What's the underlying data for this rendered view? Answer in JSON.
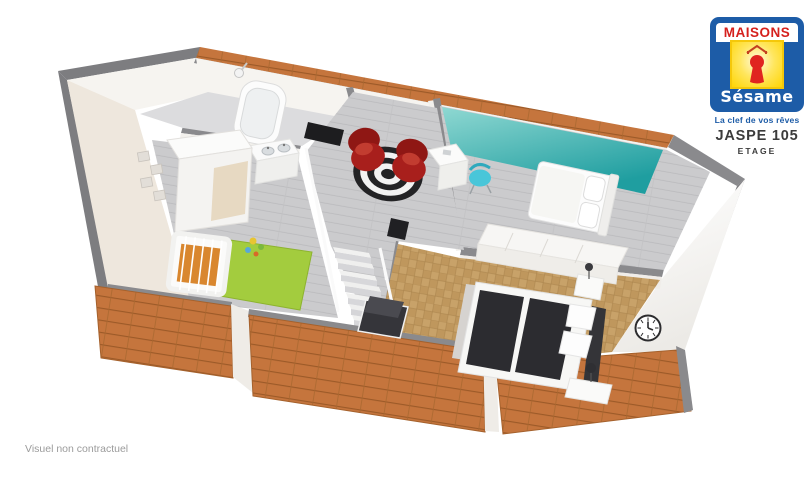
{
  "logo": {
    "brand_top": "MAISONS",
    "brand_bottom": "Sésame",
    "tagline": "La clef de vos rêves",
    "colors": {
      "blue": "#1d5ca7",
      "red": "#d5201d",
      "yellow": "#ffd504",
      "keyhole": "#e02420",
      "roof_mark": "#c3401f"
    }
  },
  "plan": {
    "model": "JASPE 105",
    "level": "ETAGE"
  },
  "footer": {
    "disclaimer": "Visuel non contractuel"
  },
  "scene": {
    "type": "3d-floorplan-cutaway",
    "level_shown": "upper floor",
    "rooms": [
      "bathroom",
      "child-bedroom",
      "landing-with-stairs",
      "bedroom-teal",
      "master-bedroom"
    ],
    "colors": {
      "roof_tile": "#c5753d",
      "roof_tile_line": "#9c5a28",
      "wall_outer": "#7d7d80",
      "wall_cap": "#8a8a8d",
      "wall_face": "#f6f4f0",
      "wall_face_shade": "#eee7dd",
      "floor_gray_wood": "#cbcbcd",
      "floor_gray_line": "#b9b9bc",
      "floor_tile_bath": "#dcdcde",
      "parquet": "#c8a269",
      "parquet_dark": "#bf975d",
      "parquet_line": "#a8824a",
      "teal_light": "#8fd8d2",
      "teal_dark": "#1f9ea0",
      "rug_green": "#a3cc3e",
      "rug_gray": "#d6d3d0",
      "chair_red": "#a81f1c",
      "chair_cyan": "#49c6d9",
      "bed_dark": "#2c2c30",
      "crib_orange": "#d9872f",
      "stripe_dark": "#232325",
      "stripe_light": "#f2f2f2"
    }
  }
}
